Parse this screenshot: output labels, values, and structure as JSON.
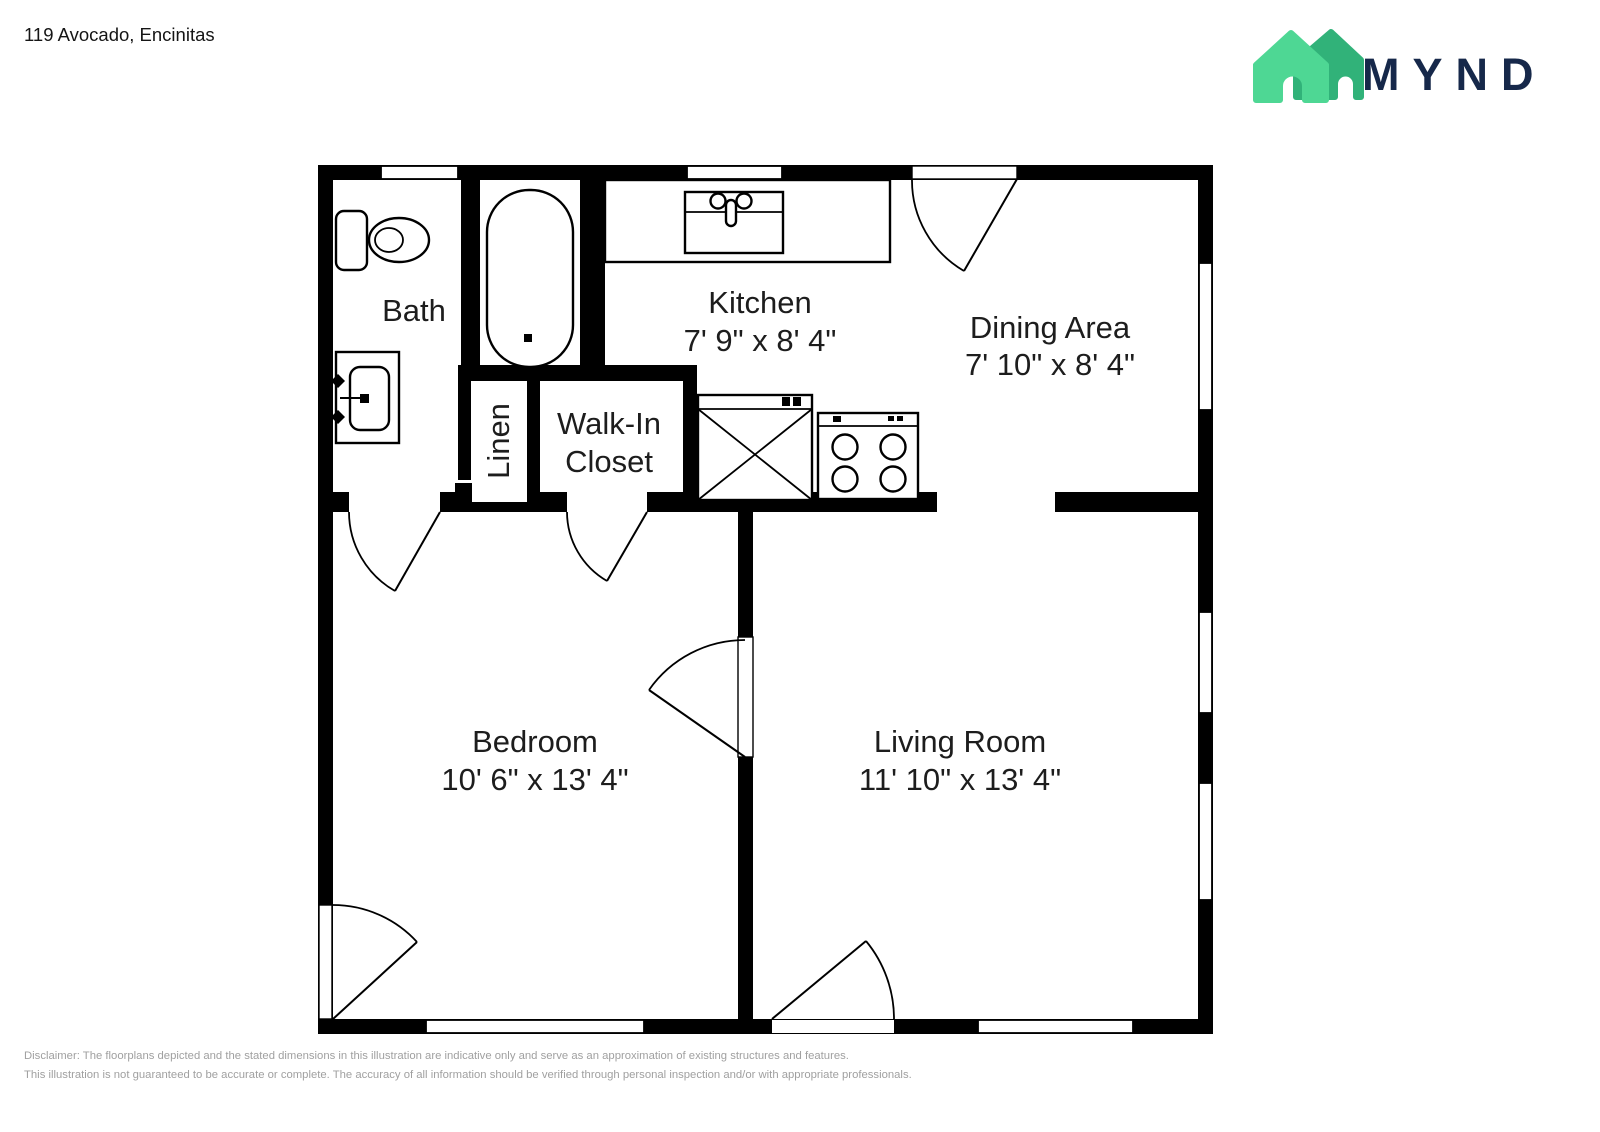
{
  "page": {
    "title": "119 Avocado, Encinitas"
  },
  "logo": {
    "brand": "MYND",
    "house_front_color": "#4ed794",
    "house_back_color": "#31b279",
    "text_color": "#16284a"
  },
  "rooms": {
    "bath": {
      "label": "Bath"
    },
    "kitchen": {
      "label": "Kitchen",
      "dims": "7' 9\" x 8' 4\""
    },
    "dining": {
      "label": "Dining Area",
      "dims": "7' 10\" x 8' 4\""
    },
    "walk_in_closet": {
      "line1": "Walk-In",
      "line2": "Closet"
    },
    "linen": {
      "label": "Linen"
    },
    "bedroom": {
      "label": "Bedroom",
      "dims": "10' 6\" x 13' 4\""
    },
    "living": {
      "label": "Living Room",
      "dims": "11' 10\" x 13' 4\""
    }
  },
  "disclaimer": {
    "line1": "Disclaimer: The floorplans depicted and the stated dimensions in this illustration are indicative only and serve as an approximation of existing structures and features.",
    "line2": "This illustration is not guaranteed to be accurate or complete. The accuracy of all information should be verified through personal inspection and/or with appropriate professionals."
  }
}
